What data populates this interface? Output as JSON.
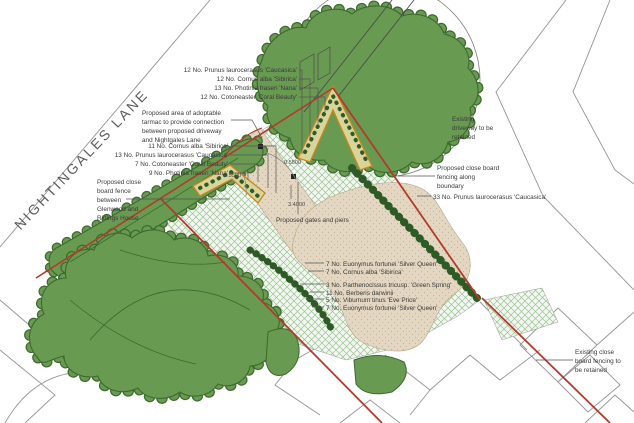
{
  "labels": {
    "road": "NIGHTINGALES LANE"
  },
  "ann": {
    "top_right": [
      "12 No. Prunus laurocerasus 'Caucasica'",
      "12 No. Cornus alba 'Sibirica'",
      "13 No. Photinia fraseri 'Nana'",
      "12 No. Cotoneaster 'Coral Beauty'"
    ],
    "tarmac_note": [
      "Proposed area of adoptable",
      "tarmac to provide connection",
      "between proposed driveway",
      "and Nightgales Lane"
    ],
    "left_planting": [
      "11 No. Cornus alba 'Sibirica'",
      "13 No. Prunus laurocerasus 'Caucasica'",
      "7 No. Cotoneaster 'Coral Beauty'",
      "9 No. Photinia fraseri 'Nana'"
    ],
    "fence_note": [
      "Proposed close",
      "board fence",
      "between",
      "Glenwood and",
      "Ridings House"
    ],
    "existing_driveway": [
      "Existing",
      "driveway to be",
      "retained"
    ],
    "boundary_fence": [
      "Proposed close board",
      "fencing along",
      "boundary"
    ],
    "prunus33": "33 No. Prunus laurocerasus 'Caucasica'",
    "bottom_planting": [
      "7 No. Euonymus fortunei 'Silver Queen'",
      "7 No. Cornus alba 'Sibirica'",
      "3 No. Parthenocissus tricusp. 'Green Spring'",
      "11 No. Berberis darwinii",
      "5 No. Viburnum tinus 'Eve Price'",
      "7 No. Euonymus fortunei 'Silver Queen'"
    ],
    "existing_fence": [
      "Existing close",
      "board fencing to",
      "be retained"
    ],
    "gates_label": "Proposed gates and piers"
  },
  "dims": {
    "pier_left": "0.5500",
    "pier_right": "0.5500",
    "gate_width": "3.4000"
  },
  "colors": {
    "canopy_green": "#699a52",
    "canopy_outline": "#3c6a2e",
    "hedge_green": "#2e5a26",
    "boundary_red": "#b23b2a",
    "bed_outline_orange": "#c8861e",
    "gravel_beige": "#e3d7c3",
    "lawn_hatch": "#9cc193",
    "survey_line": "#949494"
  }
}
